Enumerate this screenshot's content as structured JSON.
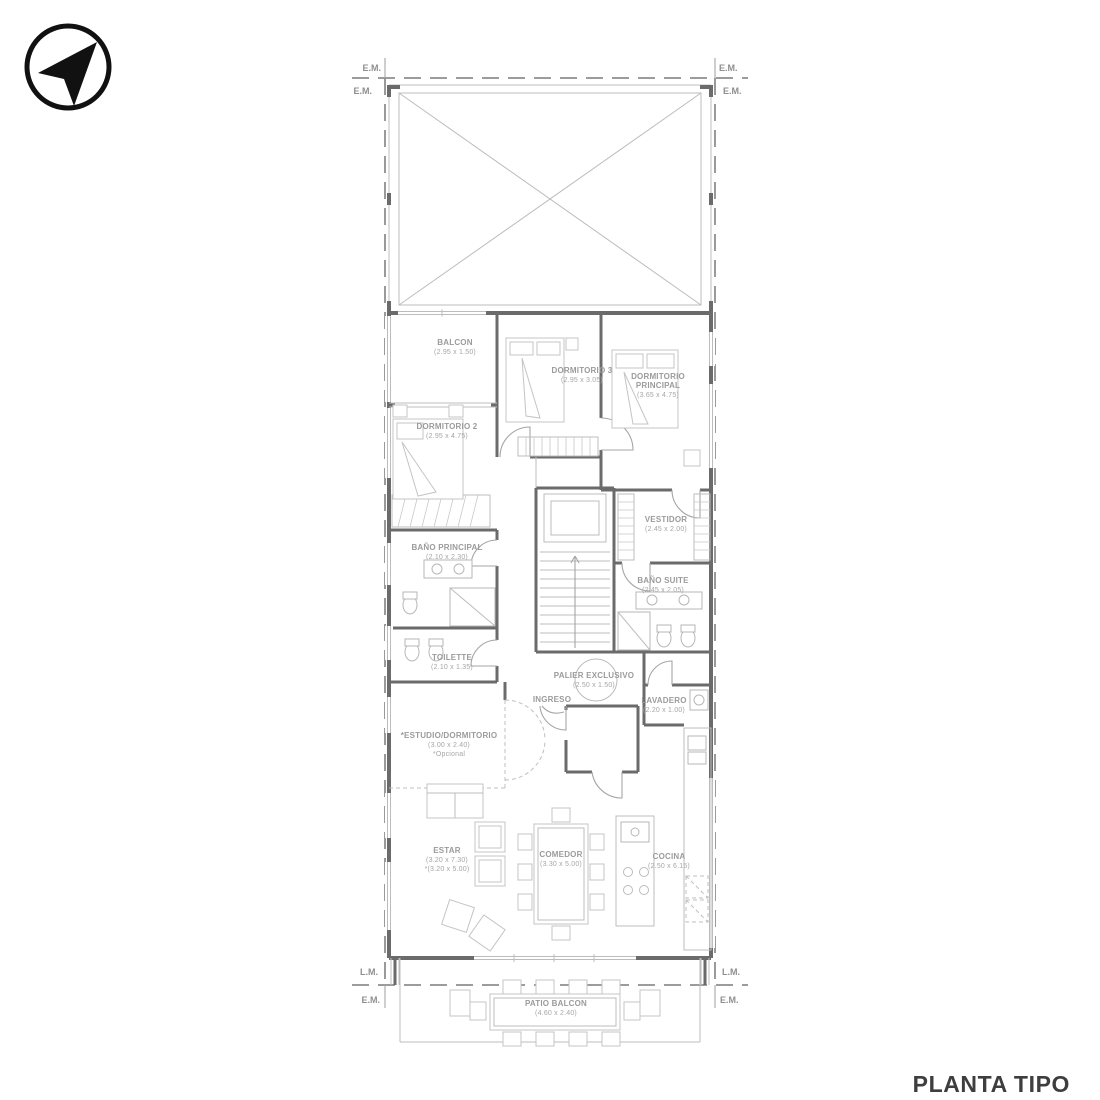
{
  "title": {
    "label": "PLANTA TIPO"
  },
  "markers": {
    "em": "E.M.",
    "lm": "L.M."
  },
  "compass": {
    "icon": "north-arrow"
  },
  "rooms": {
    "balcon": {
      "name": "BALCON",
      "dims": "(2.95 x 1.50)"
    },
    "dormitorio3": {
      "name": "DORMITORIO 3",
      "dims": "(2.95 x 3.05)"
    },
    "dormitorio_principal": {
      "name": "DORMITORIO",
      "name2": "PRINCIPAL",
      "dims": "(3.65 x 4.75)"
    },
    "dormitorio2": {
      "name": "DORMITORIO 2",
      "dims": "(2.95 x 4.75)"
    },
    "bano_principal": {
      "name": "BAÑO PRINCIPAL",
      "dims": "(2.10 x 2.30)"
    },
    "vestidor": {
      "name": "VESTIDOR",
      "dims": "(2.45 x 2.00)"
    },
    "bano_suite": {
      "name": "BAÑO SUITE",
      "dims": "(2.45 x 2.05)"
    },
    "toilette": {
      "name": "TOILETTE",
      "dims": "(2.10 x 1.35)"
    },
    "palier": {
      "name": "PALIER EXCLUSIVO",
      "dims": "(2.50 x 1.50)"
    },
    "ingreso": {
      "name": "INGRESO"
    },
    "lavadero": {
      "name": "LAVADERO",
      "dims": "(2.20 x 1.00)"
    },
    "estudio": {
      "name": "*ESTUDIO/DORMITORIO",
      "dims": "(3.00 x 2.40)",
      "note": "*Opcional"
    },
    "estar": {
      "name": "ESTAR",
      "dims": "(3.20 x 7.30)",
      "dims2": "*(3.20 x 5.00)"
    },
    "comedor": {
      "name": "COMEDOR",
      "dims": "(3.30 x 5.00)"
    },
    "cocina": {
      "name": "COCINA",
      "dims": "(2.50 x 6.15)"
    },
    "patio_balcon": {
      "name": "PATIO BALCON",
      "dims": "(4.60 x 2.40)"
    }
  },
  "colors": {
    "wall": "#6b6b6b",
    "line": "#bcbcbc",
    "label": "#9b9b9b",
    "boundary_dash": "#8f8f8f",
    "title": "#3e3e3e",
    "compass": "#111111"
  }
}
